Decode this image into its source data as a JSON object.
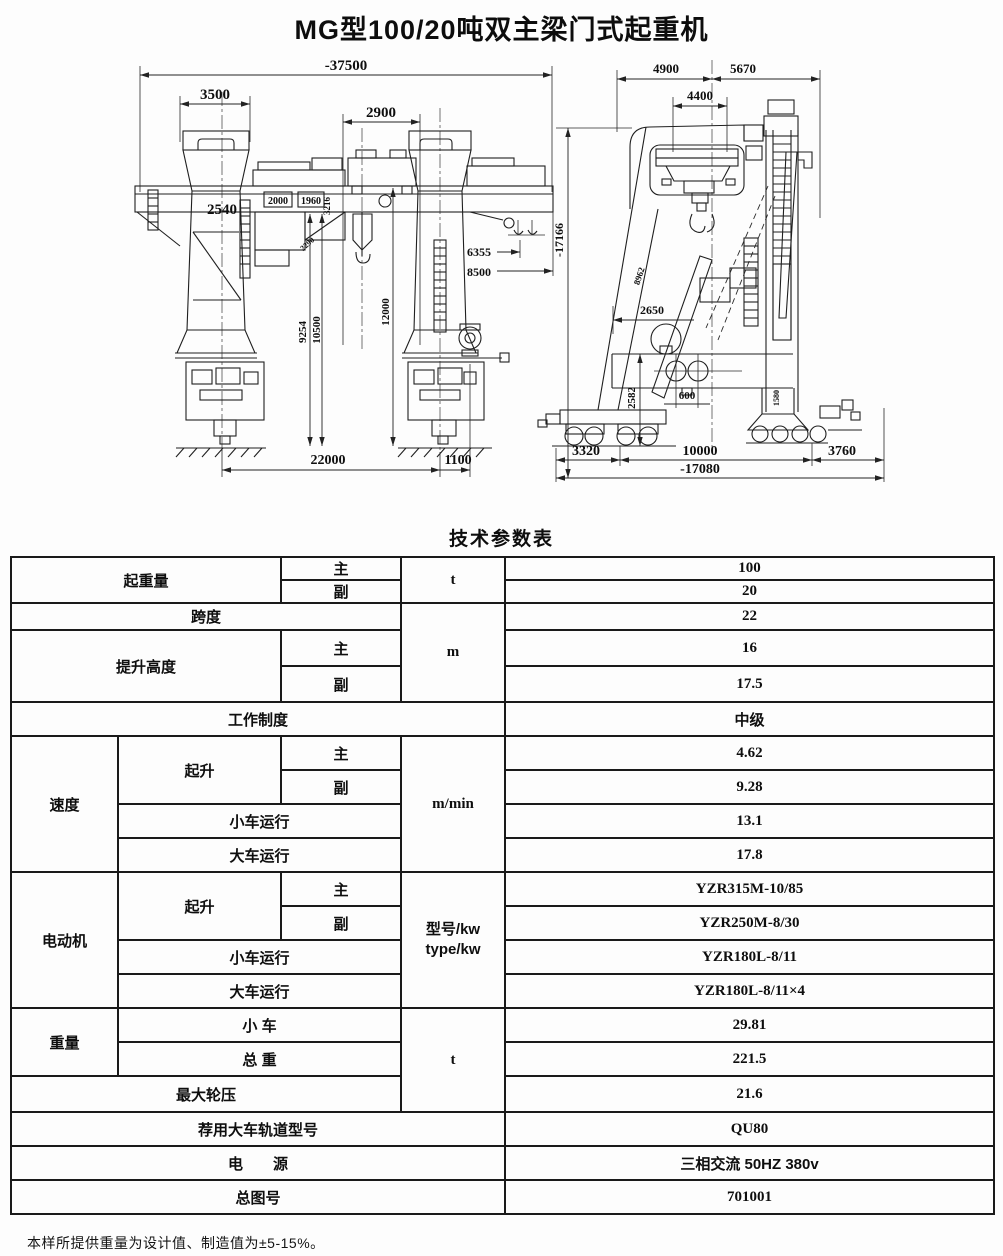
{
  "page": {
    "title": "MG型100/20吨双主梁门式起重机",
    "table_title": "技术参数表",
    "footnote": "本样所提供重量为设计值、制造值为±5-15%。"
  },
  "drawing": {
    "front_view": {
      "overall_width": "-37500",
      "cap_width": "3500",
      "hoist_width": "2900",
      "leg_width": "2540",
      "machinery_box_left": "2000",
      "machinery_box_right": "1960",
      "girder_depth": "3216",
      "brace": "2290",
      "hook_dim_upper": "6355",
      "hook_dim_lower": "8500",
      "height_a": "9254",
      "height_b": "10500",
      "height_c": "12000",
      "span": "22000",
      "overhang": "1100"
    },
    "side_view": {
      "width_left": "4900",
      "width_right": "5670",
      "cab_width": "4400",
      "overall_height": "-17166",
      "leg_length": "8962",
      "leg_offset": "2650",
      "sill_height": "2582",
      "wheel_spacing": "600",
      "leg_column": "1580",
      "margin_left": "3320",
      "wheel_base": "10000",
      "margin_right": "3760",
      "overall_length": "-17080"
    }
  },
  "table": {
    "lifting_capacity": {
      "label": "起重量",
      "main_label": "主",
      "aux_label": "副",
      "unit": "t",
      "main_value": "100",
      "aux_value": "20"
    },
    "span": {
      "label": "跨度",
      "value": "22"
    },
    "length_unit": "m",
    "lifting_height": {
      "label": "提升高度",
      "main_label": "主",
      "aux_label": "副",
      "main_value": "16",
      "aux_value": "17.5"
    },
    "duty": {
      "label": "工作制度",
      "value": "中级"
    },
    "speed": {
      "label": "速度",
      "hoist_label": "起升",
      "main_label": "主",
      "aux_label": "副",
      "trolley_label": "小车运行",
      "crane_label": "大车运行",
      "unit": "m/min",
      "main_value": "4.62",
      "aux_value": "9.28",
      "trolley_value": "13.1",
      "crane_value": "17.8"
    },
    "motor": {
      "label": "电动机",
      "hoist_label": "起升",
      "main_label": "主",
      "aux_label": "副",
      "trolley_label": "小车运行",
      "crane_label": "大车运行",
      "unit_line1": "型号/kw",
      "unit_line2": "type/kw",
      "main_value": "YZR315M-10/85",
      "aux_value": "YZR250M-8/30",
      "trolley_value": "YZR180L-8/11",
      "crane_value": "YZR180L-8/11×4"
    },
    "weight": {
      "label": "重量",
      "trolley_label": "小 车",
      "total_label": "总 重",
      "unit": "t",
      "trolley_value": "29.81",
      "total_value": "221.5"
    },
    "max_wheel_load": {
      "label": "最大轮压",
      "value": "21.6"
    },
    "rail_type": {
      "label": "荐用大车轨道型号",
      "value": "QU80"
    },
    "power": {
      "label": "电　　源",
      "value": "三相交流 50HZ 380v"
    },
    "drawing_no": {
      "label": "总图号",
      "value": "701001"
    }
  }
}
